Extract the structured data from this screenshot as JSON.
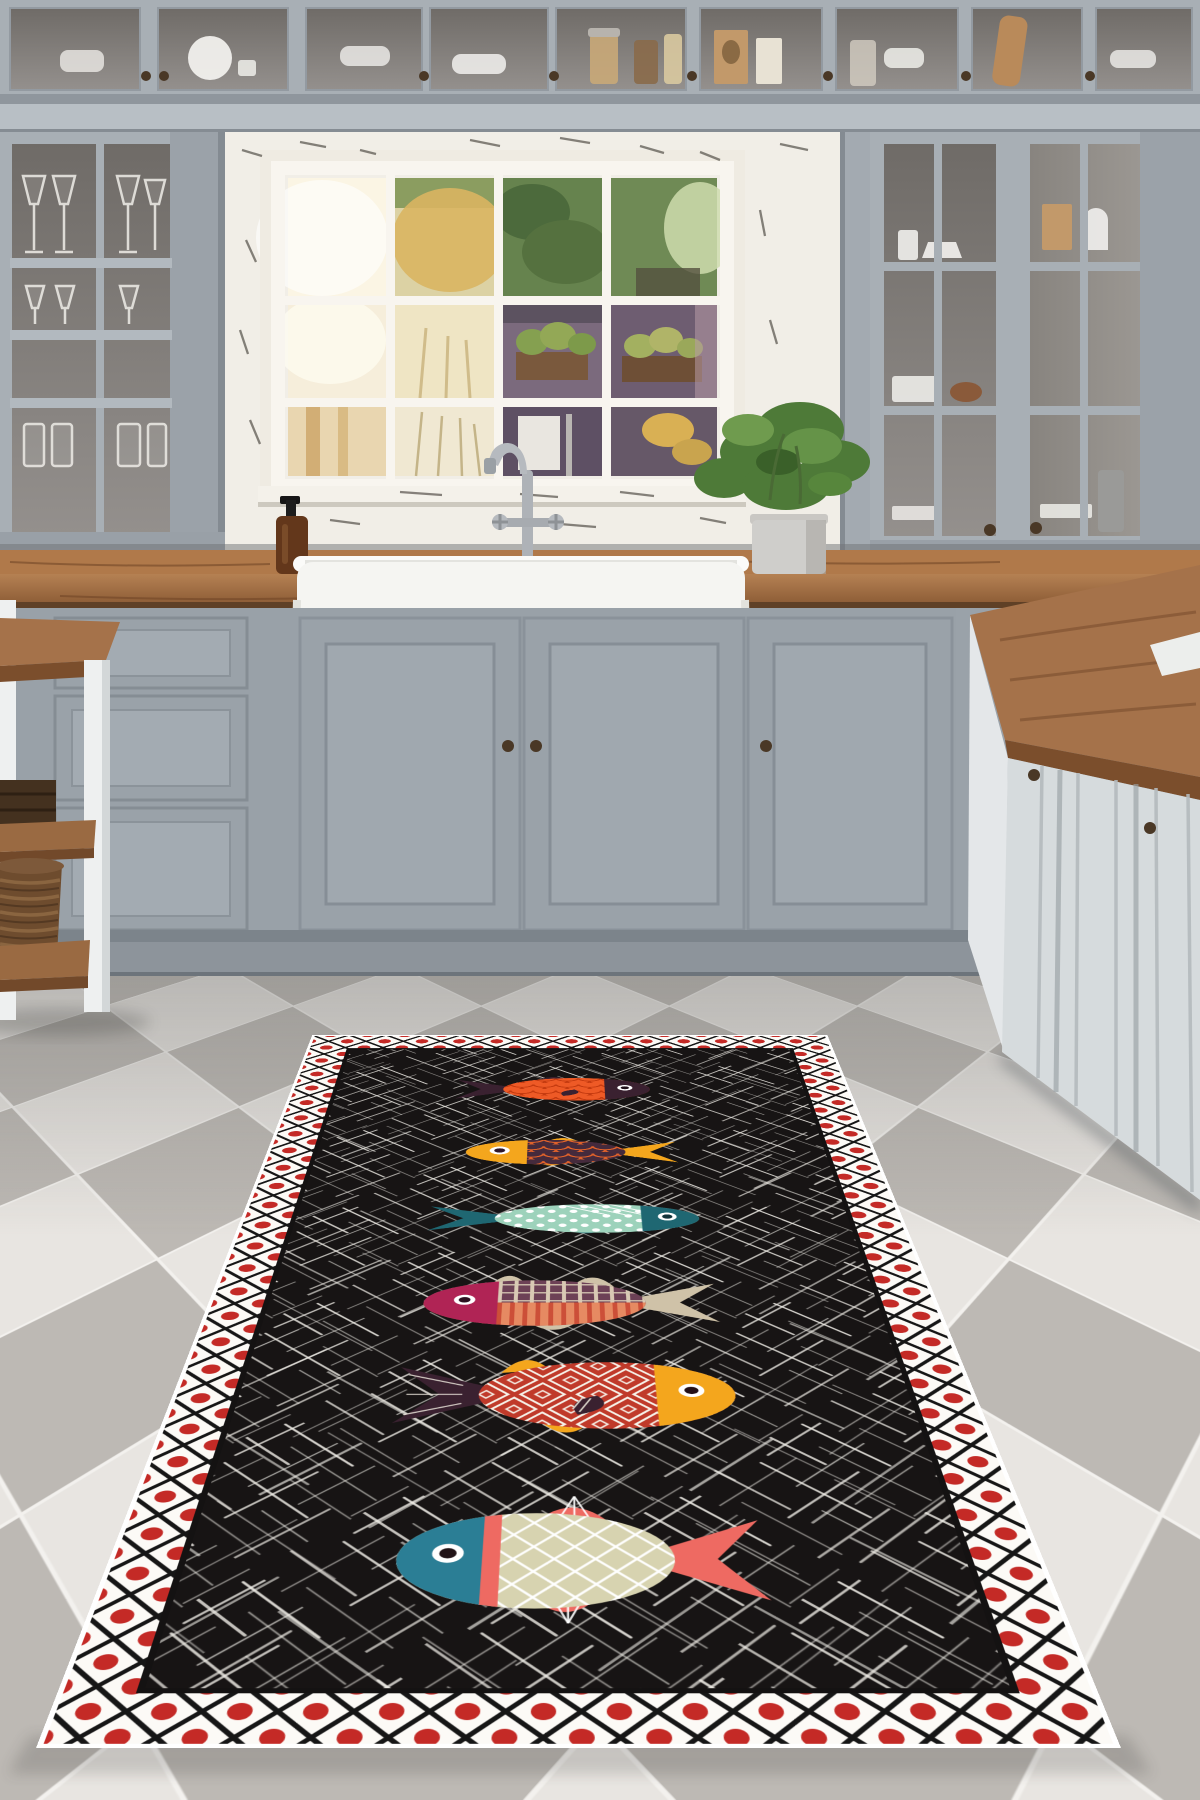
{
  "description": "Grey country kitchen with glass-front cabinets, farmhouse sink under a paned window, chequered tile floor, and a black runner rug decorated with six colourful folk-art fish inside a red-dot lattice border",
  "palette": {
    "wall": "#9aa1a8",
    "cabinet": "#a8afb5",
    "cabinet_light": "#b8bfc5",
    "cabinet_dark": "#99a1a8",
    "glass_dark": "#7e7a77",
    "beam": "#b8bfc5",
    "alcove_white": "#f1eee7",
    "sash_white": "#f8f5ef",
    "counter_wood_top": "#b0794a",
    "counter_wood_front": "#8a5a34",
    "sink_white": "#f5f5f2",
    "chrome": "#aeb2b7",
    "soap_amber": "#63371b",
    "plant_green": "#4e7a38",
    "pot_gray": "#cfcecb",
    "island_face": "#d6dbdd",
    "baseboard": "#8d949b",
    "toe_kick": "#7c848b",
    "knob_bronze": "#4a3826",
    "basket_brown": "#6e4c2e",
    "box_dark": "#44311f",
    "table_white": "#eef0f0"
  },
  "floor": {
    "tile_light": "#e8e5e1",
    "tile_gray": "#bdb9b4",
    "grout": "#f3f1ee",
    "tile_cell": 345
  },
  "window_view": {
    "foliage_green": "#66834e",
    "foliage_dark": "#4c6a3c",
    "tree_yellow": "#d9b562",
    "shed_purple": "#7b6a7d",
    "planter_brown": "#7a593d",
    "glow_white": "#fbf5e4"
  },
  "rug": {
    "field": "#171414",
    "field_edge": "#141212",
    "scratch": "#efece6",
    "border_bg": "#fcfaf6",
    "lattice": "#161616",
    "dot_red": "#c42a26",
    "binding": "#ffffff",
    "fish": [
      {
        "id": 1,
        "name": "orange scale fish",
        "facing": "right",
        "cx": 514,
        "cy": 318,
        "len": 365,
        "ht": 122,
        "headFrac": 0.24,
        "eyeR": 0.12,
        "pattern": "scales",
        "colors": {
          "body": "#ee5a26",
          "pat": "#c43a0f",
          "head": "#3a2130",
          "tail": "#3a2130",
          "fin": "#3a2130",
          "eye": "#ffffff",
          "pupil": "#1e0f18"
        },
        "pect": {
          "x": 0.1,
          "color": "#3a2130"
        },
        "fins": [
          {
            "side": "top",
            "x": -0.02,
            "w": 0.2,
            "h": 0.4
          },
          {
            "side": "bottom",
            "x": 0.05,
            "w": 0.16,
            "h": 0.34
          }
        ]
      },
      {
        "id": 2,
        "name": "yellow head plum fish",
        "facing": "left",
        "cx": 537,
        "cy": 631,
        "len": 365,
        "ht": 112,
        "headFrac": 0.3,
        "eyeR": 0.16,
        "pattern": "scales",
        "colors": {
          "body": "#452a3c",
          "pat": "#e2622a",
          "head": "#f4a61d",
          "tail": "#f4a61d",
          "fin": "#f4a61d",
          "eye": "#ffffff",
          "pupil": "#30182a"
        },
        "fins": [
          {
            "side": "top",
            "x": 0.02,
            "w": 0.2,
            "h": 0.46
          },
          {
            "side": "bottom",
            "x": 0.08,
            "w": 0.17,
            "h": 0.4
          }
        ]
      },
      {
        "id": 3,
        "name": "dotted seafoam fish",
        "facing": "right",
        "cx": 536,
        "cy": 910,
        "len": 430,
        "ht": 110,
        "headFrac": 0.22,
        "eyeR": 0.14,
        "pattern": "dots",
        "colors": {
          "body": "#9dd2bb",
          "pat": "#ffffff",
          "head": "#1f6772",
          "tail": "#1f6772",
          "fin": "#1f6772",
          "eye": "#ffffff",
          "pupil": "#12333a"
        },
        "streaks": [
          [
            -0.02,
            -0.46,
            0.16,
            -0.1
          ],
          [
            0.04,
            -0.48,
            0.22,
            -0.12
          ],
          [
            0.1,
            -0.5,
            0.28,
            -0.14
          ],
          [
            0.16,
            -0.5,
            0.33,
            -0.16
          ]
        ],
        "fins": [
          {
            "side": "bottom",
            "x": 0.06,
            "w": 0.16,
            "h": 0.36
          },
          {
            "side": "top",
            "x": 0.12,
            "w": 0.12,
            "h": 0.26
          }
        ]
      },
      {
        "id": 4,
        "name": "split striped fish",
        "facing": "left",
        "cx": 532,
        "cy": 1206,
        "len": 424,
        "ht": 145,
        "headFrac": 0.26,
        "eyeR": 0.11,
        "pattern": "split",
        "colors": {
          "bodyTop": "#6d4156",
          "bodyBottom": "#e68a62",
          "patTop": "#d9c9b4",
          "patBottom": "#cc4f38",
          "head": "#b02455",
          "tail": "#cfc2a8",
          "fin": "#cfc2a8",
          "eye": "#ffffff",
          "pupil": "#2c1220"
        },
        "fins": [
          {
            "side": "top",
            "x": -0.1,
            "w": 0.15,
            "h": 0.44
          },
          {
            "side": "top",
            "x": 0.2,
            "w": 0.14,
            "h": 0.52
          },
          {
            "side": "bottom",
            "x": 0.04,
            "w": 0.2,
            "h": 0.48
          }
        ]
      },
      {
        "id": 5,
        "name": "red diamond fish",
        "facing": "right",
        "cx": 538,
        "cy": 1472,
        "len": 445,
        "ht": 175,
        "headFrac": 0.24,
        "eyeR": 0.1,
        "pattern": "squares",
        "colors": {
          "body": "#c03a2a",
          "pat": "#f6f1e8",
          "head": "#f4a61d",
          "tail": "#3a2130",
          "fin": "#f4a61d",
          "eye": "#ffffff",
          "pupil": "#241018"
        },
        "tailStripes": "#e8e2d8",
        "pect": {
          "x": 0.08,
          "color": "#3a2130",
          "stripes": "#d8d2c8"
        },
        "fins": [
          {
            "side": "top",
            "x": -0.14,
            "w": 0.15,
            "h": 0.38
          },
          {
            "side": "bottom",
            "x": -0.02,
            "w": 0.17,
            "h": 0.42
          }
        ]
      },
      {
        "id": 6,
        "name": "big lattice fish",
        "facing": "left",
        "cx": 541,
        "cy": 1844,
        "len": 415,
        "ht": 185,
        "headFrac": 0.26,
        "eyeR": 0.1,
        "pattern": "grid",
        "gill": "#ee6a62",
        "colors": {
          "body": "#d7d3b0",
          "pat": "#ffffff",
          "head": "#2b7e95",
          "tail": "#ee6a62",
          "fin": "#ee6a62",
          "eye": "#ffffff",
          "pupil": "#221418"
        },
        "fins": [
          {
            "side": "top",
            "x": 0.0,
            "w": 0.24,
            "h": 0.44,
            "stripes": "#ffffff"
          },
          {
            "side": "bottom",
            "x": 0.02,
            "w": 0.2,
            "h": 0.38,
            "stripes": "#ffffff"
          }
        ]
      }
    ]
  }
}
